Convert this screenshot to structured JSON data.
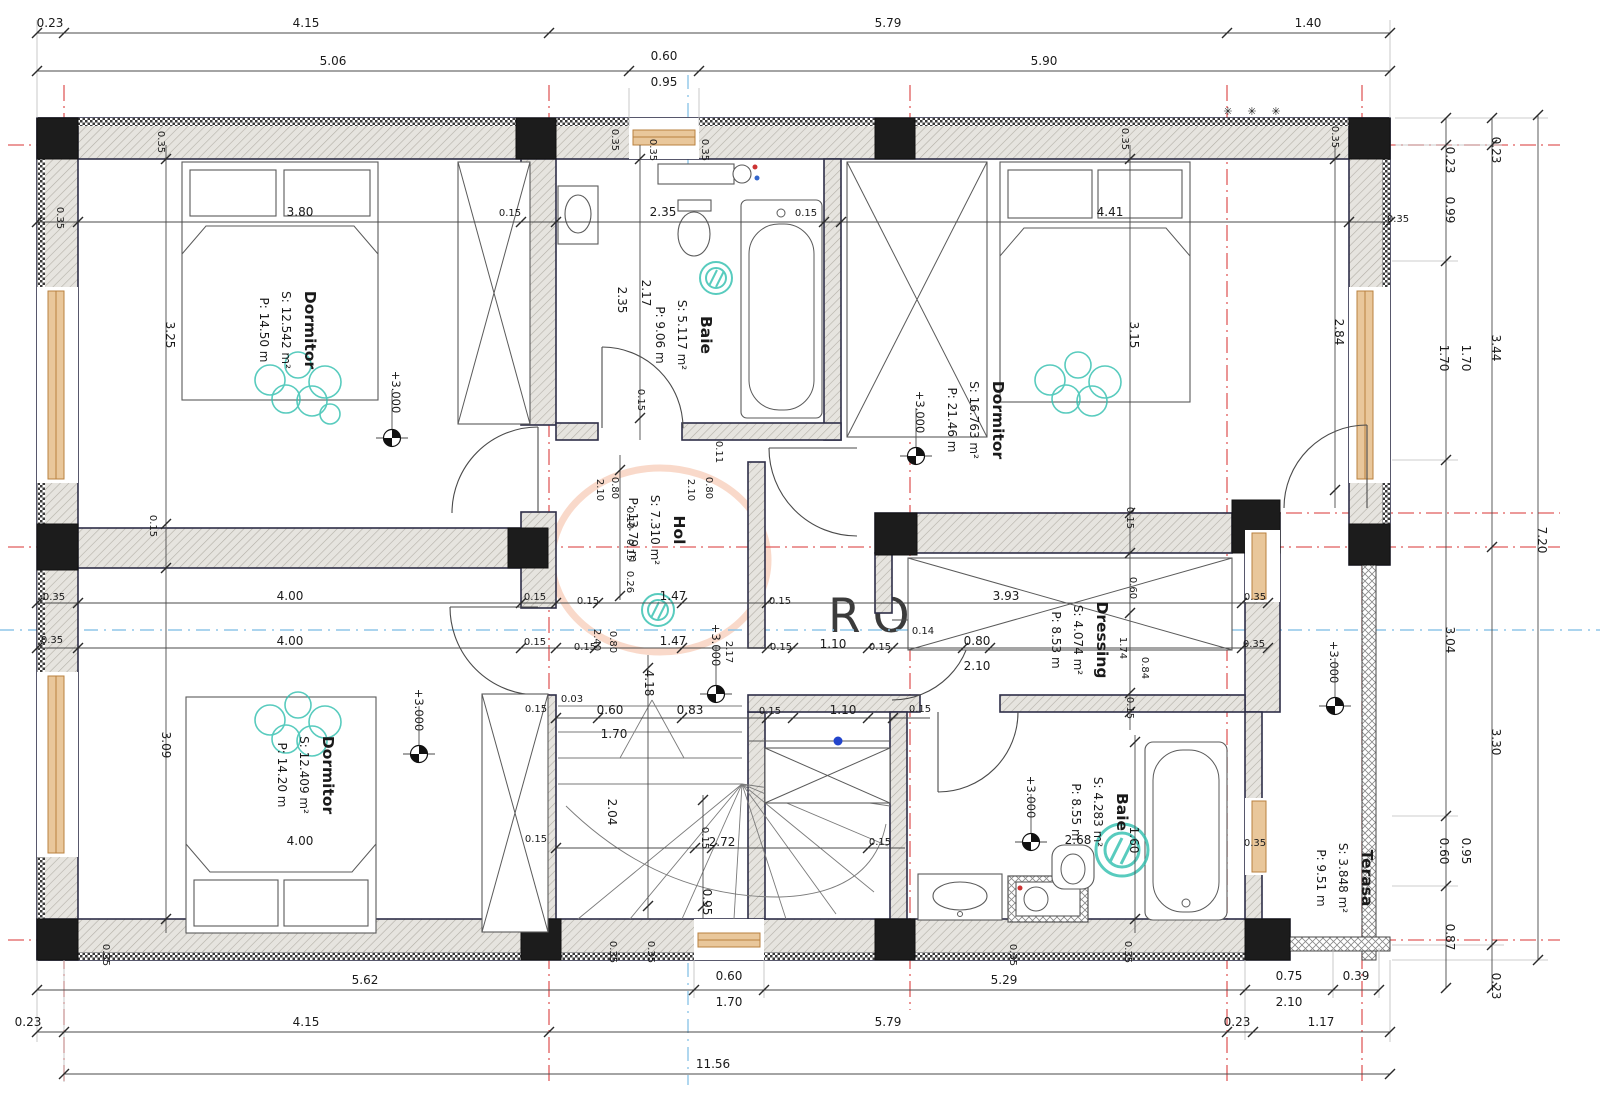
{
  "watermark": {
    "text": "ROMANIA"
  },
  "colors": {
    "axis_red": "#e05c5c",
    "axis_blue": "#8fc6e8",
    "teal_decor": "#2fbfae",
    "window_fill": "#e9c79b",
    "window_stroke": "#b9813f",
    "watermark_orange": "#f2b49c",
    "closet_dot_blue": "#2244cc",
    "wall_edge": "#2e2e48"
  },
  "rooms": [
    {
      "name": "Dormitor",
      "s": "S: 12.542 m²",
      "p": "P:  14.50 m",
      "x": 305,
      "y": 330
    },
    {
      "name": "Baie",
      "s": "S: 5.117 m²",
      "p": "P:  9.06 m",
      "x": 701,
      "y": 335
    },
    {
      "name": "Dormitor",
      "s": "S: 16.763 m²",
      "p": "P:  21.46 m",
      "x": 993,
      "y": 420
    },
    {
      "name": "Hol",
      "s": "S: 7.310 m²",
      "p": "P: 13.79 m",
      "x": 674,
      "y": 530
    },
    {
      "name": "Dressing",
      "s": "S: 4.074 m²",
      "p": "P:  8.53 m",
      "x": 1097,
      "y": 640
    },
    {
      "name": "Dormitor",
      "s": "S: 12.409 m²",
      "p": "P:  14.20 m",
      "x": 323,
      "y": 775
    },
    {
      "name": "Baie",
      "s": "S: 4.283 m²",
      "p": "P:  8.55 m",
      "x": 1117,
      "y": 812
    },
    {
      "name": "Terasa",
      "s": "S: 3.848 m²",
      "p": "P:  9.51 m",
      "x": 1362,
      "y": 878
    }
  ],
  "levels": [
    {
      "t": "+3.000",
      "x": 392,
      "y": 392,
      "sx": 392,
      "sy": 438
    },
    {
      "t": "+3.000",
      "x": 916,
      "y": 412,
      "sx": 916,
      "sy": 456
    },
    {
      "t": "+3.000",
      "x": 712,
      "y": 645,
      "sx": 716,
      "sy": 694
    },
    {
      "t": "+3.000",
      "x": 415,
      "y": 710,
      "sx": 419,
      "sy": 754
    },
    {
      "t": "+3.000",
      "x": 1027,
      "y": 797,
      "sx": 1031,
      "sy": 842
    },
    {
      "t": "+3.000",
      "x": 1330,
      "y": 662,
      "sx": 1335,
      "sy": 706
    }
  ],
  "dims": [
    {
      "t": "0.23",
      "x": 50,
      "y": 27
    },
    {
      "t": "4.15",
      "x": 306,
      "y": 27
    },
    {
      "t": "5.79",
      "x": 888,
      "y": 27
    },
    {
      "t": "1.40",
      "x": 1308,
      "y": 27
    },
    {
      "t": "5.06",
      "x": 333,
      "y": 65
    },
    {
      "t": "0.60",
      "x": 664,
      "y": 60
    },
    {
      "t": "0.95",
      "x": 664,
      "y": 86
    },
    {
      "t": "5.90",
      "x": 1044,
      "y": 65
    },
    {
      "t": "5.62",
      "x": 365,
      "y": 984
    },
    {
      "t": "0.60",
      "x": 729,
      "y": 980
    },
    {
      "t": "1.70",
      "x": 729,
      "y": 1006
    },
    {
      "t": "5.29",
      "x": 1004,
      "y": 984
    },
    {
      "t": "0.75",
      "x": 1289,
      "y": 980
    },
    {
      "t": "2.10",
      "x": 1289,
      "y": 1006
    },
    {
      "t": "0.39",
      "x": 1356,
      "y": 980
    },
    {
      "t": "0.23",
      "x": 28,
      "y": 1026
    },
    {
      "t": "4.15",
      "x": 306,
      "y": 1026
    },
    {
      "t": "5.79",
      "x": 888,
      "y": 1026
    },
    {
      "t": "0.23",
      "x": 1237,
      "y": 1026
    },
    {
      "t": "1.17",
      "x": 1321,
      "y": 1026
    },
    {
      "t": "11.56",
      "x": 713,
      "y": 1068
    },
    {
      "t": "0.23",
      "x": 1446,
      "y": 160,
      "r": 90
    },
    {
      "t": "0.99",
      "x": 1446,
      "y": 210,
      "r": 90
    },
    {
      "t": "1.70",
      "x": 1440,
      "y": 358,
      "r": 90
    },
    {
      "t": "1.70",
      "x": 1462,
      "y": 358,
      "r": 90
    },
    {
      "t": "3.04",
      "x": 1446,
      "y": 640,
      "r": 90
    },
    {
      "t": "0.60",
      "x": 1440,
      "y": 851,
      "r": 90
    },
    {
      "t": "0.95",
      "x": 1462,
      "y": 851,
      "r": 90
    },
    {
      "t": "0.87",
      "x": 1446,
      "y": 937,
      "r": 90
    },
    {
      "t": "0.23",
      "x": 1492,
      "y": 150,
      "r": 90
    },
    {
      "t": "3.44",
      "x": 1492,
      "y": 348,
      "r": 90
    },
    {
      "t": "3.30",
      "x": 1492,
      "y": 742,
      "r": 90
    },
    {
      "t": "0.23",
      "x": 1492,
      "y": 986,
      "r": 90
    },
    {
      "t": "7.20",
      "x": 1538,
      "y": 540,
      "r": 90
    },
    {
      "t": "3.80",
      "x": 300,
      "y": 216
    },
    {
      "t": "0.15",
      "x": 510,
      "y": 216,
      "s": 10
    },
    {
      "t": "2.35",
      "x": 663,
      "y": 216
    },
    {
      "t": "0.15",
      "x": 806,
      "y": 216,
      "s": 10
    },
    {
      "t": "4.41",
      "x": 1110,
      "y": 216
    },
    {
      "t": "0.35",
      "x": 57,
      "y": 218,
      "r": 90,
      "s": 10
    },
    {
      "t": "0.35",
      "x": 158,
      "y": 142,
      "r": 90,
      "s": 10
    },
    {
      "t": "0.35",
      "x": 612,
      "y": 140,
      "r": 90,
      "s": 10
    },
    {
      "t": "0.35",
      "x": 650,
      "y": 150,
      "r": 90,
      "s": 10
    },
    {
      "t": "0.35",
      "x": 702,
      "y": 150,
      "r": 90,
      "s": 10
    },
    {
      "t": "0.35",
      "x": 1122,
      "y": 139,
      "r": 90,
      "s": 10
    },
    {
      "t": "0.35",
      "x": 1332,
      "y": 137,
      "r": 90,
      "s": 10
    },
    {
      "t": "0.35",
      "x": 1398,
      "y": 222,
      "s": 10
    },
    {
      "t": "3.25",
      "x": 166,
      "y": 335,
      "r": 90
    },
    {
      "t": "2.35",
      "x": 618,
      "y": 300,
      "r": 90
    },
    {
      "t": "2.17",
      "x": 642,
      "y": 293,
      "r": 90
    },
    {
      "t": "3.15",
      "x": 1130,
      "y": 335,
      "r": 90
    },
    {
      "t": "2.84",
      "x": 1335,
      "y": 332,
      "r": 90
    },
    {
      "t": "0.15",
      "x": 638,
      "y": 400,
      "r": 90,
      "s": 10
    },
    {
      "t": "0.11",
      "x": 716,
      "y": 452,
      "r": 90,
      "s": 10
    },
    {
      "t": "0.15",
      "x": 150,
      "y": 526,
      "r": 90,
      "s": 10
    },
    {
      "t": "2.10",
      "x": 597,
      "y": 490,
      "r": 90,
      "s": 10
    },
    {
      "t": "0.80",
      "x": 612,
      "y": 488,
      "r": 90,
      "s": 10
    },
    {
      "t": "0.10",
      "x": 627,
      "y": 518,
      "r": 90,
      "s": 10
    },
    {
      "t": "0.15",
      "x": 627,
      "y": 550,
      "r": 90,
      "s": 10
    },
    {
      "t": "0.26",
      "x": 627,
      "y": 582,
      "r": 90,
      "s": 10
    },
    {
      "t": "2.10",
      "x": 688,
      "y": 490,
      "r": 90,
      "s": 10
    },
    {
      "t": "0.80",
      "x": 706,
      "y": 488,
      "r": 90,
      "s": 10
    },
    {
      "t": "2.17",
      "x": 726,
      "y": 652,
      "r": 90,
      "s": 10
    },
    {
      "t": "0.15",
      "x": 588,
      "y": 604,
      "s": 10
    },
    {
      "t": "1.47",
      "x": 673,
      "y": 600
    },
    {
      "t": "0.15",
      "x": 780,
      "y": 604,
      "s": 10
    },
    {
      "t": "2.40",
      "x": 594,
      "y": 640,
      "r": 90,
      "s": 10
    },
    {
      "t": "0.80",
      "x": 610,
      "y": 642,
      "r": 90,
      "s": 10
    },
    {
      "t": "0.15",
      "x": 585,
      "y": 650,
      "s": 10
    },
    {
      "t": "1.47",
      "x": 673,
      "y": 645
    },
    {
      "t": "0.15",
      "x": 781,
      "y": 650,
      "s": 10
    },
    {
      "t": "1.10",
      "x": 833,
      "y": 648
    },
    {
      "t": "0.15",
      "x": 880,
      "y": 650,
      "s": 10
    },
    {
      "t": "0.14",
      "x": 923,
      "y": 634,
      "s": 10
    },
    {
      "t": "0.80",
      "x": 977,
      "y": 645
    },
    {
      "t": "2.10",
      "x": 977,
      "y": 670
    },
    {
      "t": "3.93",
      "x": 1006,
      "y": 600
    },
    {
      "t": "0.15",
      "x": 1127,
      "y": 518,
      "r": 90,
      "s": 10
    },
    {
      "t": "0.60",
      "x": 1130,
      "y": 588,
      "r": 90,
      "s": 10
    },
    {
      "t": "0.15",
      "x": 1127,
      "y": 708,
      "r": 90,
      "s": 10
    },
    {
      "t": "1.74",
      "x": 1120,
      "y": 648,
      "r": 90,
      "s": 10
    },
    {
      "t": "0.84",
      "x": 1142,
      "y": 668,
      "r": 90,
      "s": 10
    },
    {
      "t": "0.35",
      "x": 1255,
      "y": 600,
      "s": 10
    },
    {
      "t": "0.35",
      "x": 1254,
      "y": 647,
      "s": 10
    },
    {
      "t": "4.00",
      "x": 290,
      "y": 600
    },
    {
      "t": "4.00",
      "x": 290,
      "y": 645
    },
    {
      "t": "0.15",
      "x": 535,
      "y": 600,
      "s": 10
    },
    {
      "t": "0.15",
      "x": 535,
      "y": 645,
      "s": 10
    },
    {
      "t": "0.35",
      "x": 54,
      "y": 600,
      "s": 10
    },
    {
      "t": "0.35",
      "x": 52,
      "y": 643,
      "s": 10
    },
    {
      "t": "3.09",
      "x": 162,
      "y": 745,
      "r": 90
    },
    {
      "t": "4.00",
      "x": 300,
      "y": 845
    },
    {
      "t": "0.15",
      "x": 536,
      "y": 712,
      "s": 10
    },
    {
      "t": "0.15",
      "x": 536,
      "y": 842,
      "s": 10
    },
    {
      "t": "0.03",
      "x": 572,
      "y": 702,
      "s": 10
    },
    {
      "t": "0.60",
      "x": 610,
      "y": 714
    },
    {
      "t": "1.70",
      "x": 614,
      "y": 738
    },
    {
      "t": "0.83",
      "x": 690,
      "y": 714
    },
    {
      "t": "4.18",
      "x": 645,
      "y": 683,
      "r": 90
    },
    {
      "t": "2.04",
      "x": 608,
      "y": 812,
      "r": 90
    },
    {
      "t": "0.15",
      "x": 702,
      "y": 838,
      "r": 90,
      "s": 10
    },
    {
      "t": "2.72",
      "x": 722,
      "y": 846
    },
    {
      "t": "0.95",
      "x": 703,
      "y": 902,
      "r": 90
    },
    {
      "t": "0.15",
      "x": 770,
      "y": 714,
      "s": 10
    },
    {
      "t": "1.10",
      "x": 843,
      "y": 714
    },
    {
      "t": "0.15",
      "x": 920,
      "y": 712,
      "s": 10
    },
    {
      "t": "0.15",
      "x": 880,
      "y": 845,
      "s": 10
    },
    {
      "t": "2.68",
      "x": 1078,
      "y": 844
    },
    {
      "t": "1.60",
      "x": 1130,
      "y": 840,
      "r": 90
    },
    {
      "t": "0.35",
      "x": 1255,
      "y": 846,
      "s": 10
    },
    {
      "t": "0.35",
      "x": 103,
      "y": 955,
      "r": 90,
      "s": 10
    },
    {
      "t": "0.35",
      "x": 610,
      "y": 952,
      "r": 90,
      "s": 10
    },
    {
      "t": "0.35",
      "x": 648,
      "y": 952,
      "r": 90,
      "s": 10
    },
    {
      "t": "0.35",
      "x": 1010,
      "y": 955,
      "r": 90,
      "s": 10
    },
    {
      "t": "0.35",
      "x": 1125,
      "y": 952,
      "r": 90,
      "s": 10
    }
  ]
}
